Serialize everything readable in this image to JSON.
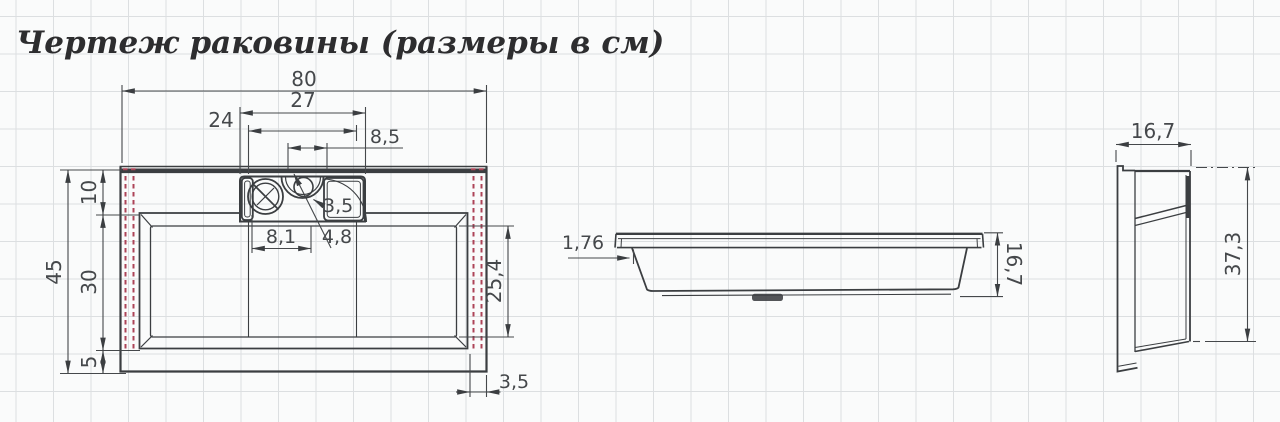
{
  "title": "Чертеж раковины (размеры в см)",
  "colors": {
    "line": "#3b3e41",
    "dim_text": "#45484b",
    "red_dashed": "#ad4458",
    "grid": "#dcdfe1",
    "background": "#fafbfb"
  },
  "top_view": {
    "label": "top view of sink",
    "dims": {
      "width_overall": "80",
      "shelf_width": "27",
      "shelf_inner": "24",
      "holes_span": "8,5",
      "notch_radius": "3,5",
      "hole_spacing": "8,1",
      "hole_diameter": "4,8",
      "depth_overall": "45",
      "back_depth": "10",
      "basin_depth": "30",
      "front_margin": "5",
      "basin_inner_depth": "25,4",
      "side_margin": "3,5"
    }
  },
  "front_view": {
    "label": "front view of sink",
    "dims": {
      "rim_overhang": "1,76",
      "height": "16,7"
    }
  },
  "side_view": {
    "label": "side view of sink",
    "dims": {
      "top_width": "16,7",
      "height": "37,3"
    }
  }
}
